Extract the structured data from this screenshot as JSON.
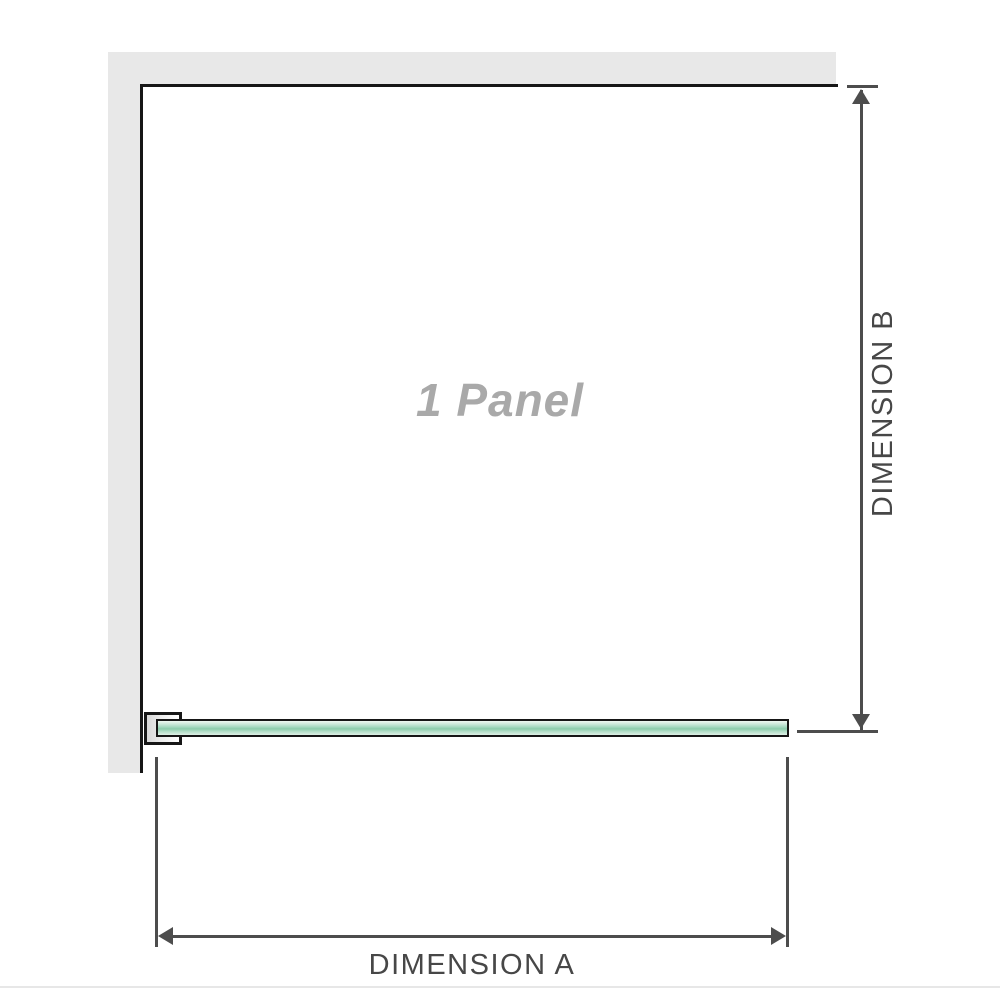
{
  "diagram": {
    "panel_label": "1 Panel",
    "dimension_a": {
      "label": "DIMENSION A",
      "orientation": "horizontal"
    },
    "dimension_b": {
      "label": "DIMENSION B",
      "orientation": "vertical"
    }
  },
  "icons": {
    "dimension_b_arrows": [
      "arrow-up-icon",
      "arrow-down-icon"
    ],
    "dimension_a_arrows": [
      "arrow-left-icon",
      "arrow-right-icon"
    ]
  },
  "colors": {
    "wall": "#e8e8e8",
    "outline": "#161616",
    "dimension": "#4d4d4d",
    "label_text": "#474747",
    "panel_label_text": "#a9a9a9",
    "glass_green": "#8cccab",
    "divider": "#e7e7e7"
  }
}
